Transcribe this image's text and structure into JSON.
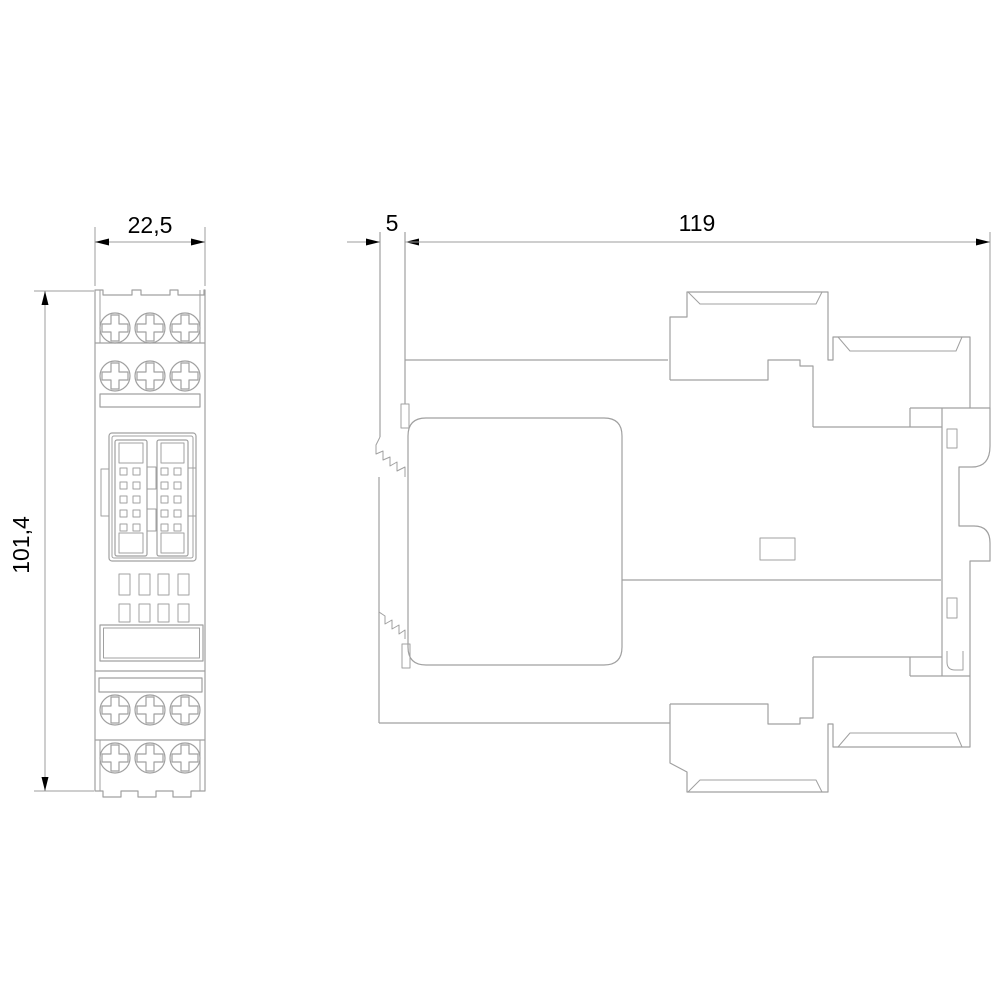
{
  "dimensions": {
    "front_width": "22,5",
    "front_height": "101,4",
    "side_gap": "5",
    "side_depth": "119"
  },
  "colors": {
    "background": "#ffffff",
    "object_line": "#a0a0a0",
    "dimension_line": "#9c9c9c",
    "dimension_text": "#000000",
    "arrow": "#000000"
  }
}
